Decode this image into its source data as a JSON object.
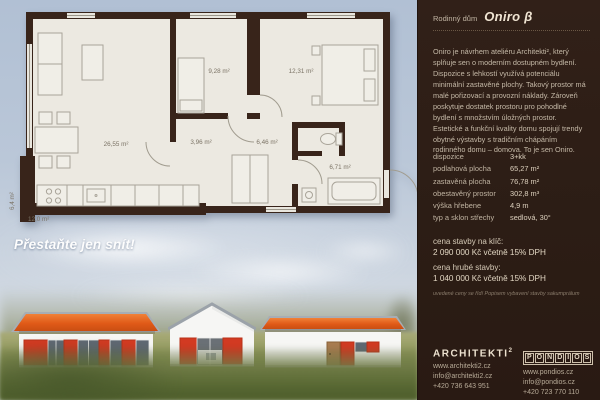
{
  "hero": {
    "slogan": "Přestaňte jen snít!"
  },
  "floorplan": {
    "rooms": [
      {
        "name": "living-kitchen",
        "area": "26,55 m²"
      },
      {
        "name": "bedroom-1",
        "area": "9,28 m²"
      },
      {
        "name": "bedroom-2",
        "area": "12,31 m²"
      },
      {
        "name": "hall",
        "area": "3,96 m²"
      },
      {
        "name": "corridor",
        "area": "6,46 m²"
      },
      {
        "name": "bathroom",
        "area": "6,71 m²"
      }
    ],
    "terrace_area": "12,0 m²",
    "side_terrace_area": "6,4 m²"
  },
  "panel": {
    "header": {
      "prefix": "Rodinný dům",
      "title": "Oniro β"
    },
    "description": "Oniro je návrhem ateliéru Architekti², který splňuje sen o moderním dostupném bydlení. Dispozice s lehkostí využívá potenciálu minimální zastavěné plochy. Takový prostor má malé pořizovací a provozní náklady. Zároveň poskytuje dostatek prostoru pro pohodlné bydlení s množstvím úložných prostor. Estetické a funkční kvality domu spojují trendy obytné výstavby s tradičním chápáním rodinného domu – domova. To je sen Oniro.",
    "specs": [
      {
        "label": "dispozice",
        "value": "3+kk"
      },
      {
        "label": "podlahová plocha",
        "value": "65,27 m²"
      },
      {
        "label": "zastavěná plocha",
        "value": "76,78 m²"
      },
      {
        "label": "obestavěný prostor",
        "value": "302,8 m³"
      },
      {
        "label": "výška hřebene",
        "value": "4,9 m"
      },
      {
        "label": "typ a sklon střechy",
        "value": "sedlová, 30°"
      }
    ],
    "prices": [
      {
        "label": "cena stavby na klíč:",
        "value": "2 090 000 Kč včetně 15% DPH"
      },
      {
        "label": "cena hrubé stavby:",
        "value": "1 040 000 Kč včetně 15% DPH"
      }
    ],
    "note": "uvedené ceny se řídí Popisem vybavení stavby sakumprálum",
    "footer": {
      "architekti": {
        "name": "ARCHITEKTI",
        "sup": "2",
        "lines": [
          "www.architekti2.cz",
          "info@architekti2.cz",
          "+420 736 643 951"
        ]
      },
      "pondios": {
        "name": "PONDIOS",
        "lines": [
          "www.pondios.cz",
          "info@pondios.cz",
          "+420 723 770 110"
        ]
      }
    }
  },
  "colors": {
    "panel_bg": "#2c1d15",
    "plan_wall": "#38241a",
    "plan_floor": "#ece9e1",
    "roof_orange": "#e05a18",
    "shutter_red": "#d23a22",
    "sky": "#b7c5d7"
  }
}
